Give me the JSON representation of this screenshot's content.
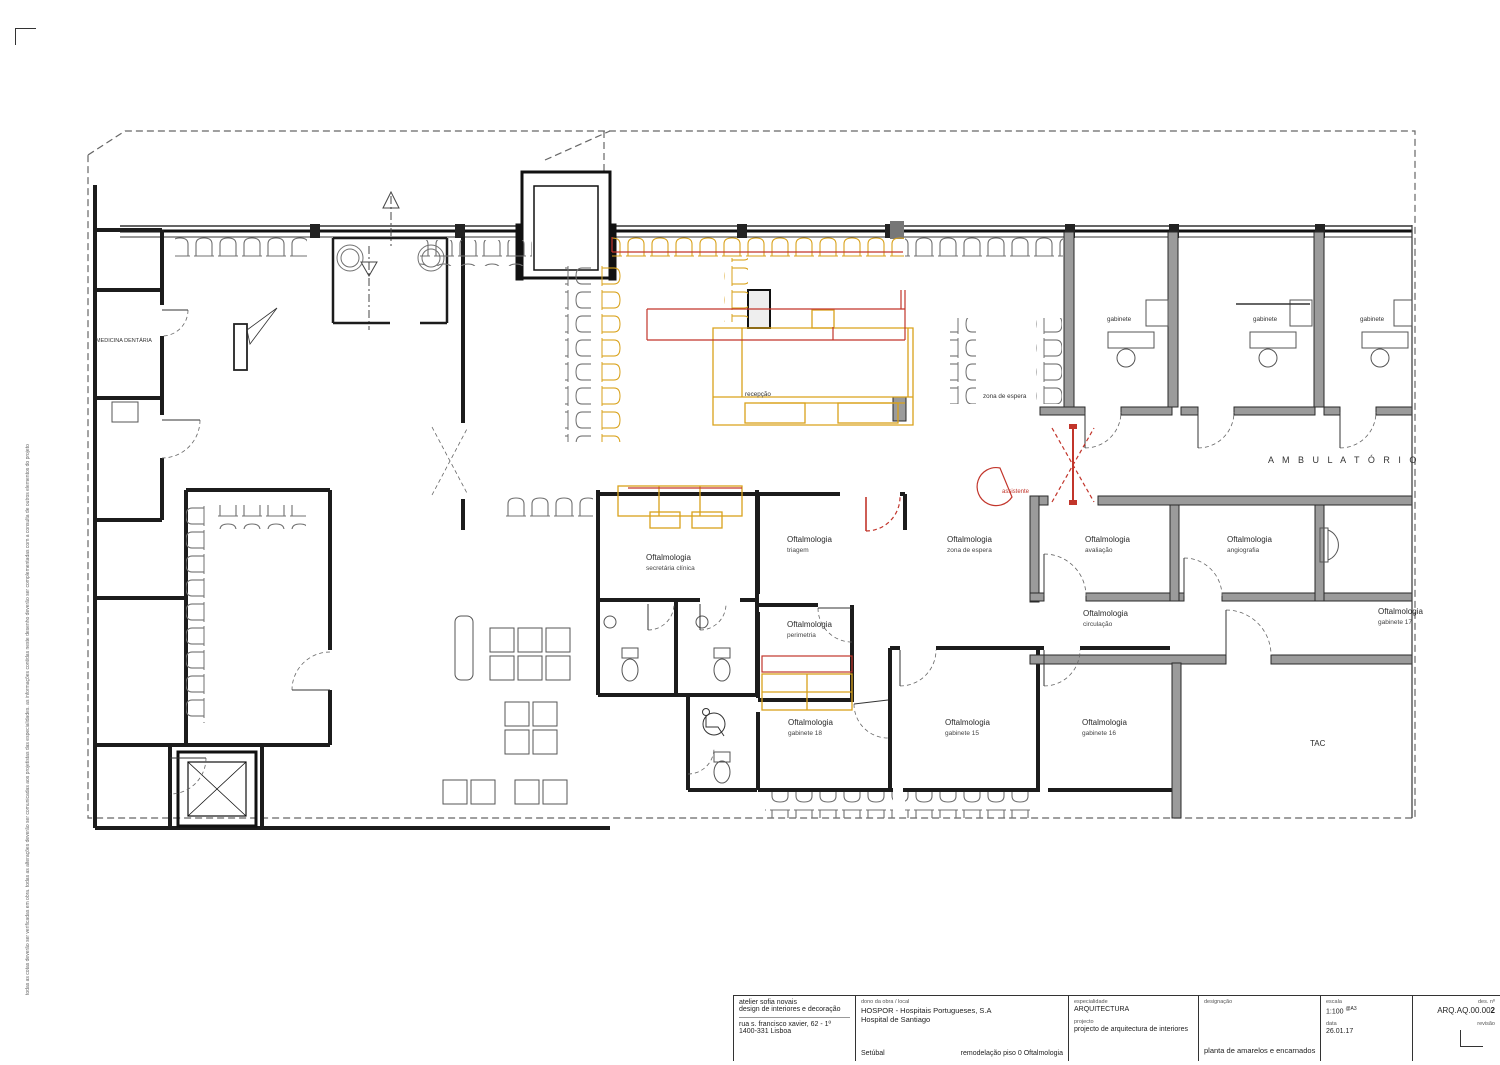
{
  "colors": {
    "demolition_yellow": "#d9a21b",
    "new_red": "#c2352b",
    "wall_black": "#1c1c1c",
    "wall_gray": "#9b9b9b"
  },
  "plan": {
    "medicina_dentaria": "MEDICINA DENTÁRIA",
    "recepcao": "recepção",
    "zona_de_espera_top": "zona de espera",
    "gabinete": "gabinete",
    "ambulatorio": "A M B U L A T Ó R I O",
    "assistente": "assistente",
    "tac": "TAC",
    "oftalmologia": "Oftalmologia",
    "rooms": {
      "secretaria": "secretária clínica",
      "triagem": "triagem",
      "zona_de_espera": "zona de espera",
      "avaliacao": "avaliação",
      "angiografia": "angiografia",
      "circulacao": "circulação",
      "gabinete17": "gabinete 17",
      "perimetria": "perimetria",
      "gabinete18": "gabinete 18",
      "gabinete15": "gabinete 15",
      "gabinete16": "gabinete 16"
    }
  },
  "side_note": "todas as cotas deverão ser verificadas em obra. todas as alterações deverão ser comunicadas aos projetistas das especialidades. as informações contidas neste desenho deverão ser complementadas com a consulta de outros elementos do projeto",
  "title_block": {
    "architect": {
      "line1": "atelier sofia novais",
      "line2": "design de interiores e decoração",
      "line3": "rua s. francisco xavier, 62 - 1º",
      "line4": "1400-331 Lisboa"
    },
    "owner": {
      "label": "dono da obra / local",
      "line1": "HOSPOR - Hospitais Portugueses, S.A",
      "line2": "Hospital de Santiago",
      "line3": "Setúbal",
      "line4": "remodelação piso 0 Oftalmologia"
    },
    "specialty": {
      "label": "especialidade",
      "value": "ARQUITECTURA",
      "label2": "projecto",
      "value2": "projecto de arquitectura de interiores"
    },
    "designation": {
      "label": "designação",
      "value": "planta de amarelos e encarnados"
    },
    "scale": {
      "label": "escala",
      "value": "1:100",
      "format": "@A3",
      "date_label": "data",
      "date": "26.01.17"
    },
    "number": {
      "label": "des. nº",
      "value": "ARQ.AQ.00.00",
      "value_bold": "2",
      "revision_label": "revisão"
    }
  }
}
